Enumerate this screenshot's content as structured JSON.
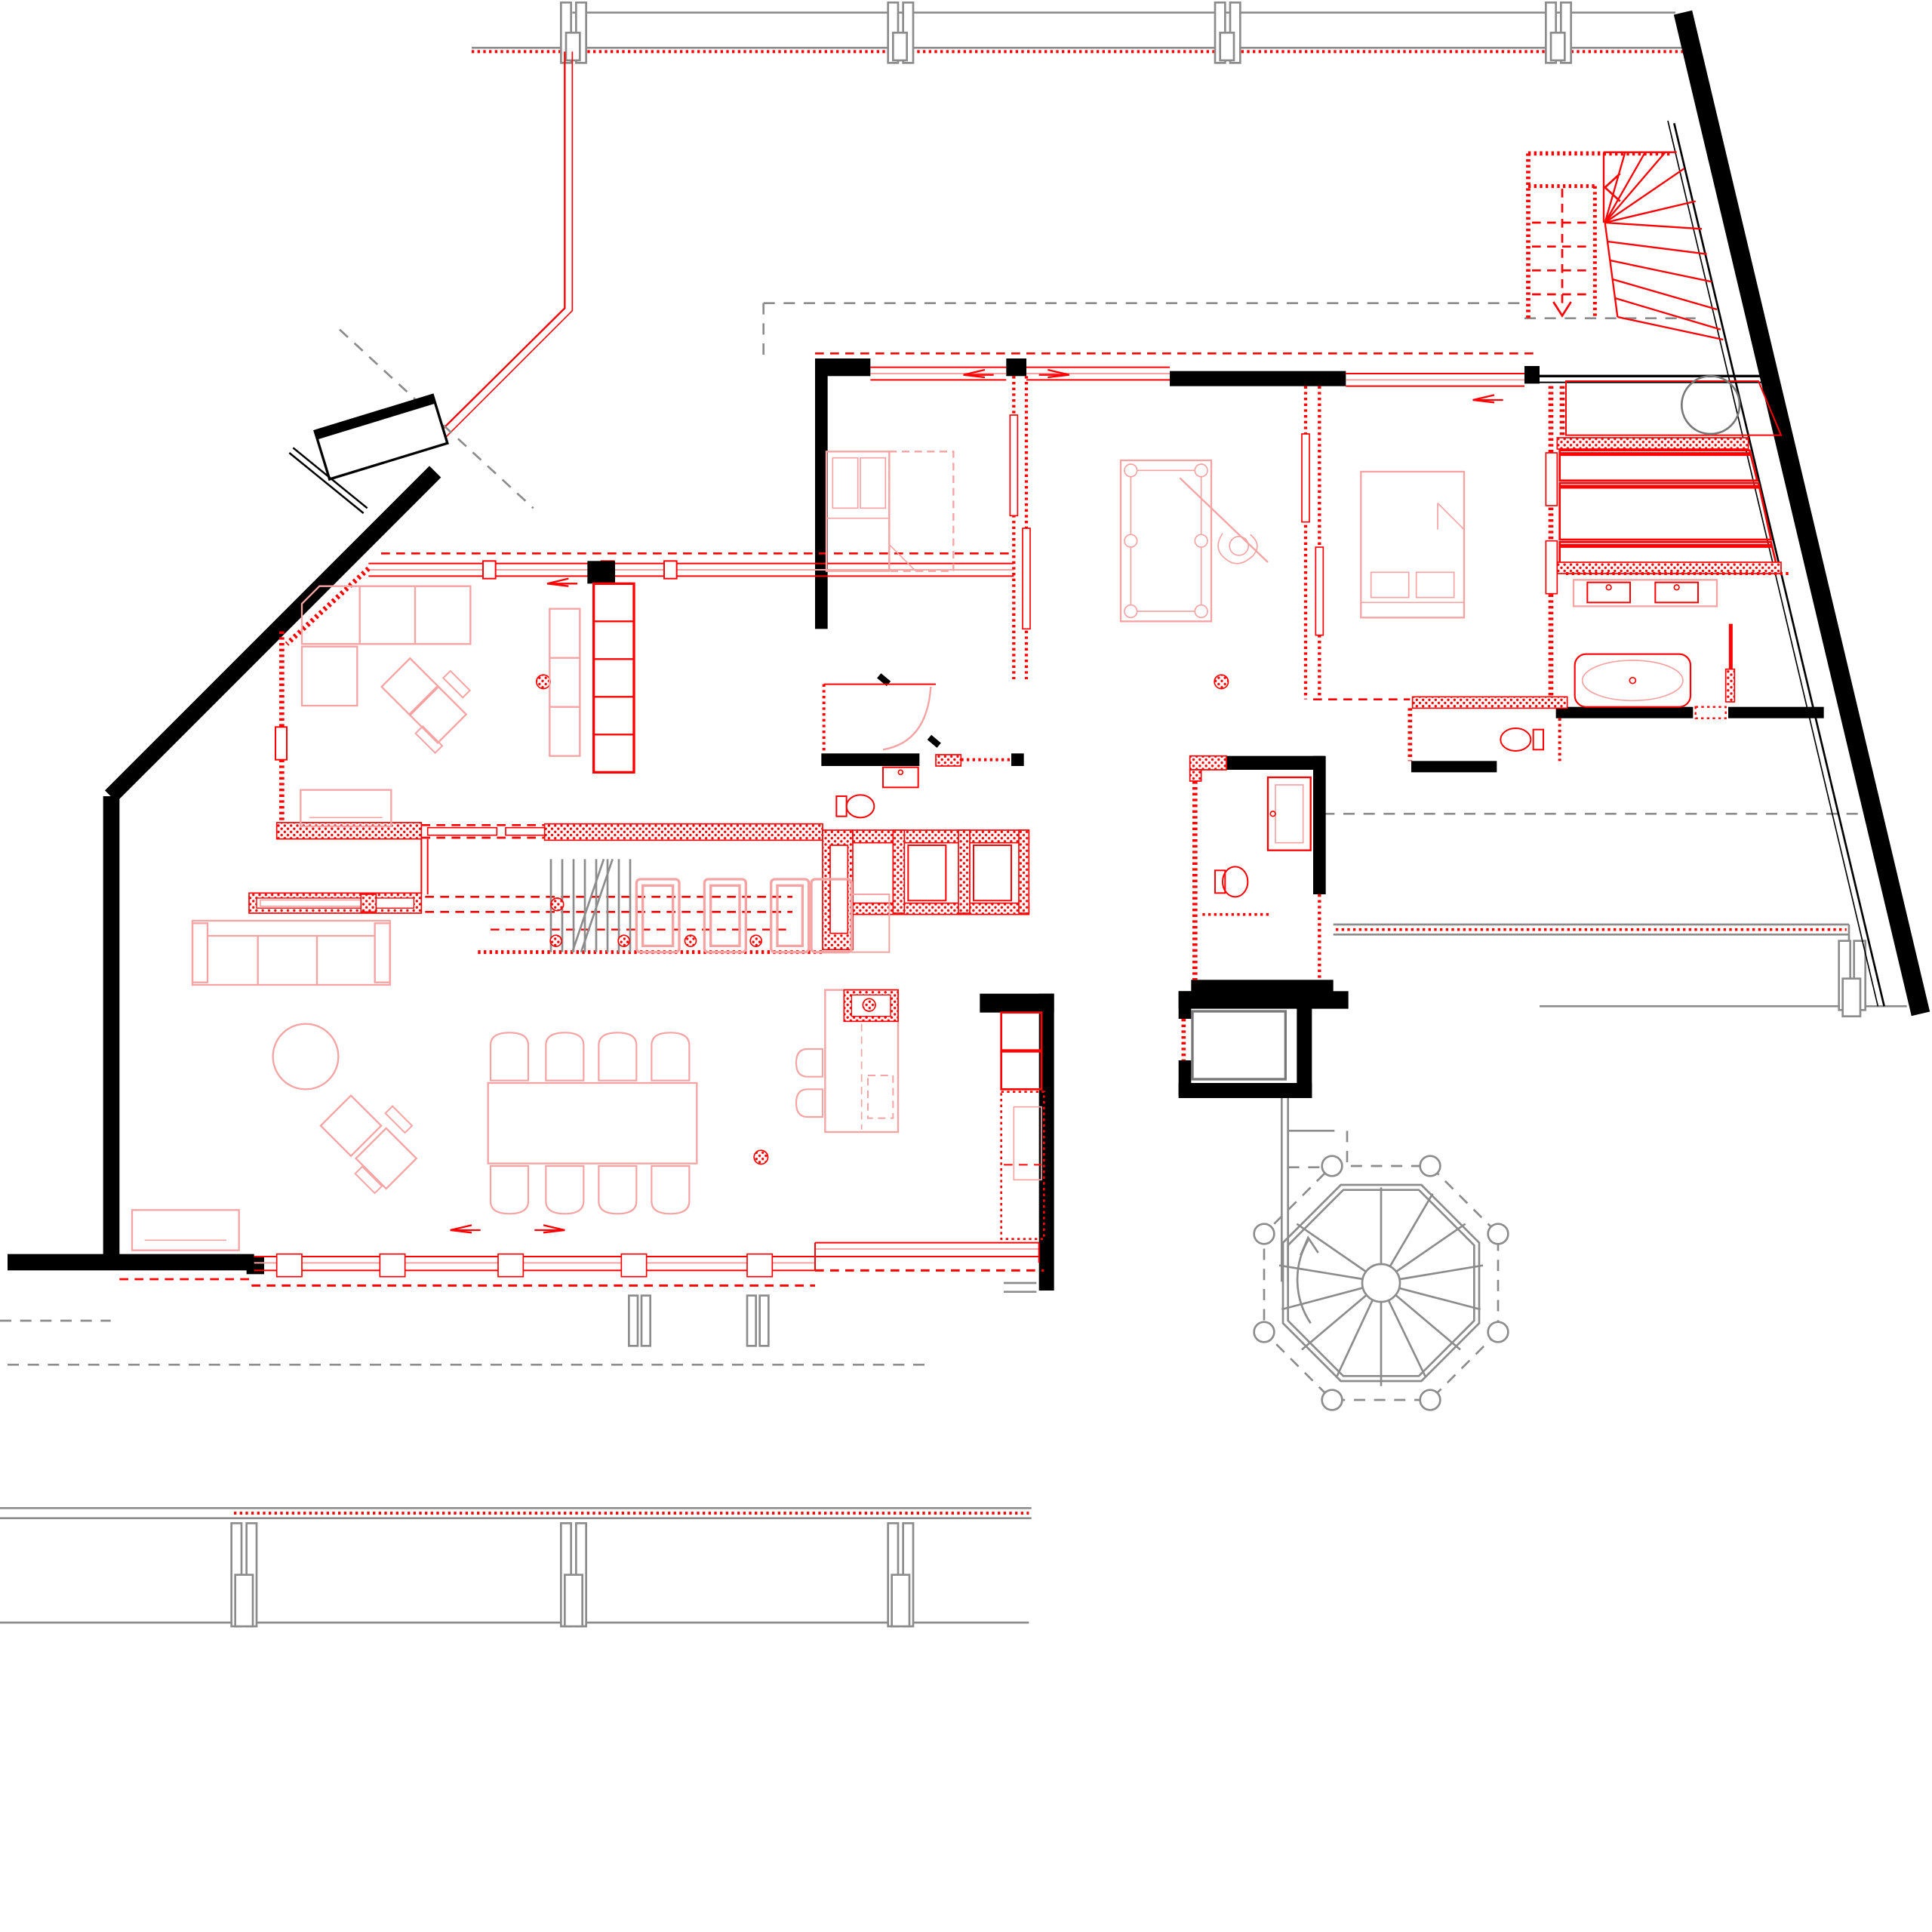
{
  "plan": {
    "title": "Attic penthouse floor plan",
    "type": "architectural-floor-plan",
    "scale_text": "",
    "colors": {
      "wall": "#000000",
      "fixture": "#ff0000",
      "furniture": "#f5a3a3",
      "shell": "#8c8c8c",
      "background": "#ffffff"
    },
    "line_legend": {
      "solid_black_thick": "load-bearing walls",
      "solid_red": "new partitions and fixtures",
      "red_dotted": "insulated light partitions",
      "red_dashed": "sliding tracks and roof edges above",
      "gray_thin": "building shell, terrace and mullions",
      "gray_dashed": "roof outline above"
    },
    "rooms": {
      "family_room": "family room with corner sofa, lounge chairs, bookshelf and sideboard",
      "bedroom_1": "bedroom with fold-out double bed",
      "billiard_room": "billiard room with pool table and player figure",
      "bedroom_2": "master bedroom with double bed",
      "dressing": "wardrobe with three shelf bays",
      "master_bath": "bathroom with double vanity, bathtub and shower",
      "wc_1": "guest WC with toilet",
      "shower_room_1": "en-suite shower room with sink and toilet",
      "shower_room_2": "shower room beside elevator with shower and toilet",
      "kitchen": "kitchen row with appliances and pantry",
      "living_dining": "living and dining space with sofa, dining table and island",
      "entry": "entry hall with closets",
      "top_right_room": "north-east room with round fixture"
    },
    "fixtures": {
      "spiral_staircase": "octagonal spiral staircase with radial treads",
      "winder_staircase": "red winder staircase to roof level",
      "basement_stair": "straight stair going down beside kitchen",
      "elevator": "elevator shaft with cab",
      "bathtub": "freestanding oval bathtub",
      "double_vanity": "vanity with two sinks",
      "pool_table": "six-pocket billiard table",
      "island": "kitchen island with sink and two bar stools",
      "fireplace": "media / fireplace cabinet band",
      "columns": "round hatched structural columns"
    },
    "furniture_counts": {
      "dining_chairs": 8,
      "bar_stools": 2,
      "sofas": 3,
      "lounge_chairs": 4,
      "beds": 2,
      "toilets": 3,
      "sinks": 4,
      "ceiling_spots_row": 4
    },
    "mullion_positions_top": [
      455,
      715,
      975,
      1238
    ],
    "mullion_positions_south": [
      224,
      306,
      400,
      498,
      598
    ],
    "terrace_posts_south": [
      188,
      450,
      710
    ]
  }
}
